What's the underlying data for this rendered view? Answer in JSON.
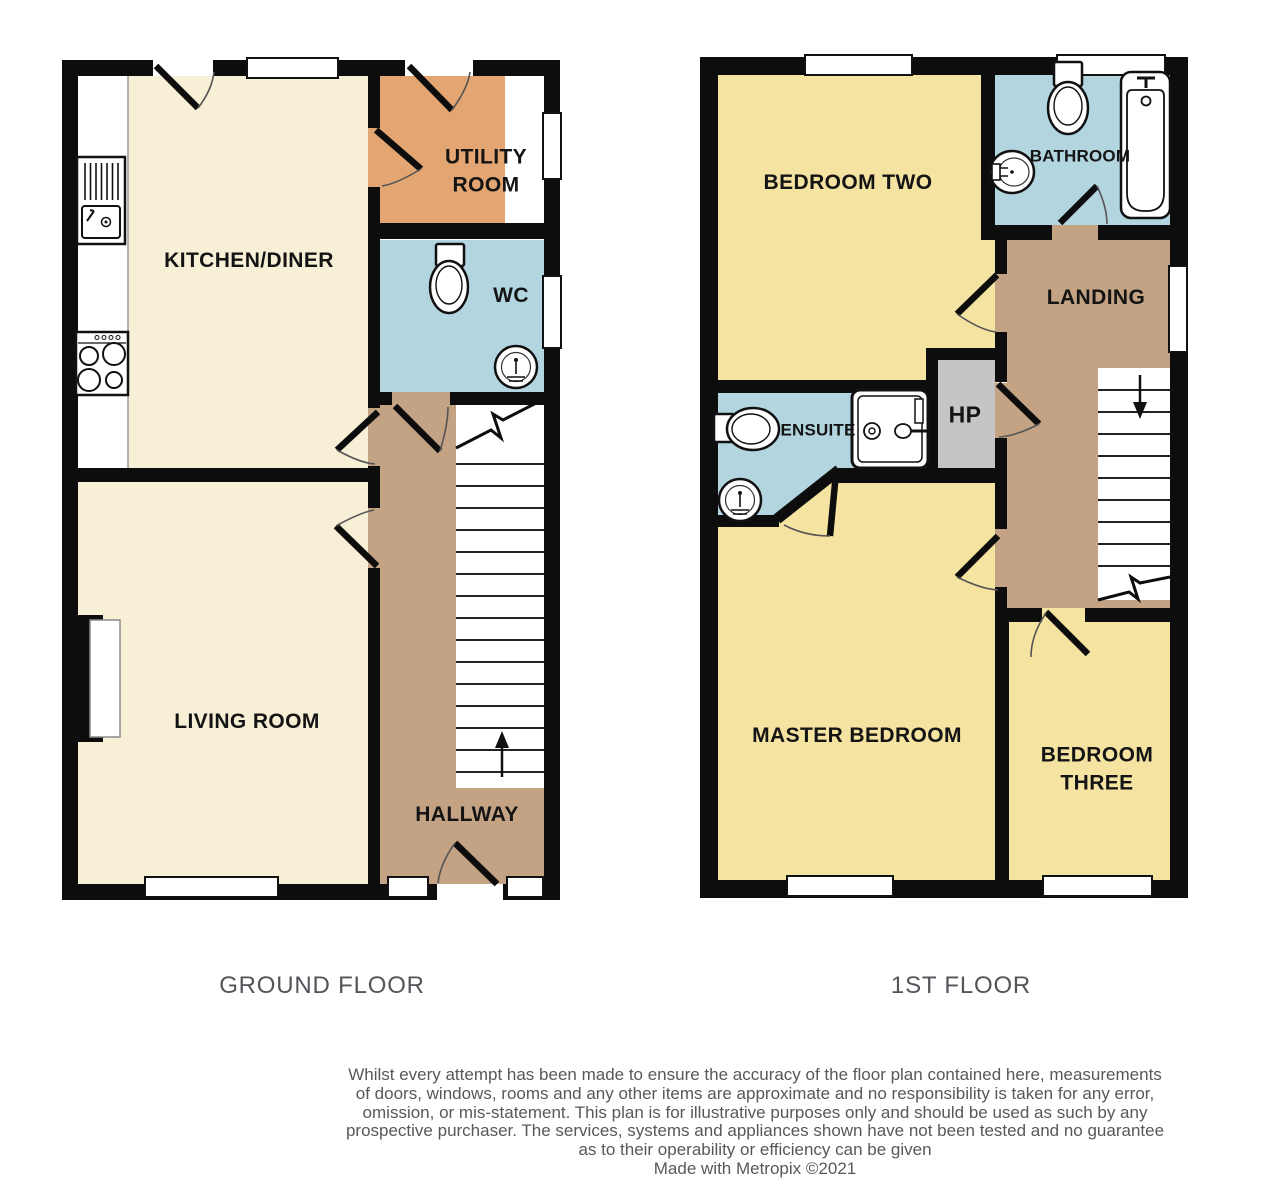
{
  "ground_floor": {
    "title": "GROUND FLOOR",
    "rooms": {
      "kitchen_diner": "KITCHEN/DINER",
      "utility_room": "UTILITY\nROOM",
      "wc": "WC",
      "living_room": "LIVING ROOM",
      "hallway": "HALLWAY"
    }
  },
  "first_floor": {
    "title": "1ST FLOOR",
    "rooms": {
      "bedroom_two": "BEDROOM TWO",
      "bathroom": "BATHROOM",
      "landing": "LANDING",
      "ensuite": "ENSUITE",
      "hp": "HP",
      "master_bedroom": "MASTER BEDROOM",
      "bedroom_three": "BEDROOM\nTHREE"
    }
  },
  "footer": {
    "disclaimer_lines": [
      "Whilst every attempt has been made to ensure the accuracy of the floor plan contained here, measurements",
      "of doors, windows, rooms and any other items are approximate and no responsibility is taken for any error,",
      "omission, or mis-statement. This plan is for illustrative purposes only and should be used as such by any",
      "prospective purchaser. The services, systems and appliances shown have not been tested and no guarantee",
      "as to their operability or efficiency can be given",
      "Made with Metropix ©2021"
    ]
  },
  "palette": {
    "room_cream": "#F7EFD6",
    "bedroom_yellow": "#F4E3A1",
    "utility_orange": "#E3A672",
    "wet_room_blue": "#B2D5E0",
    "hall_brown": "#C3A383",
    "cupboard_gray": "#C5C5C7",
    "wall_black": "#0D0D0D",
    "title_gray": "#54555A"
  },
  "icons": {
    "kitchen_sink": "kitchen-sink-icon",
    "hob": "hob-icon",
    "toilet": "toilet-icon",
    "pedestal_sink": "pedestal-sink-icon",
    "oval_sink": "oval-sink-icon",
    "bath": "bath-icon",
    "shower": "shower-icon",
    "stairs_up": "stairs-up-arrow-icon",
    "stairs_down": "stairs-down-arrow-icon"
  }
}
